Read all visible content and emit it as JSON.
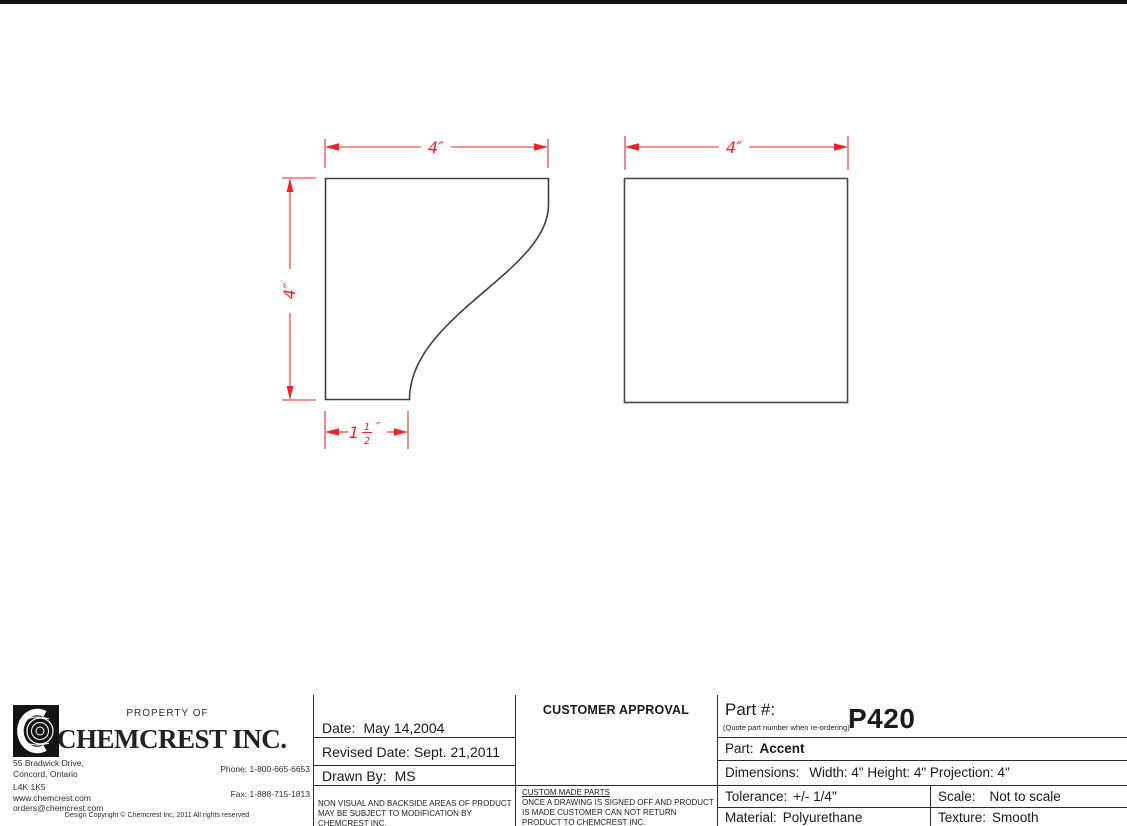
{
  "drawing": {
    "dim_color": "#ee2328",
    "outline_color": "#3f3f3f",
    "profile_view": {
      "width_label": "4″",
      "height_label": "4″",
      "bottom_width": {
        "whole": "1",
        "numerator": "1",
        "denominator": "2",
        "unit": "″"
      }
    },
    "face_view": {
      "width_label": "4″"
    }
  },
  "title_block": {
    "company": {
      "property_of": "PROPERTY OF",
      "name": "CHEMCREST INC.",
      "logo_icon": "chemcrest-c-medallion",
      "address_line1": "55 Bradwick Drive,",
      "address_line2": "Concord, Ontario",
      "address_line3": "L4K 1K5",
      "address_line4": "www.chemcrest.com",
      "address_line5": "orders@chemcrest.com",
      "phone": "Phone: 1-800-665-6653",
      "fax": "Fax: 1-888-715-1813",
      "copyright": "Design Copyright © Chemcrest Inc, 2011 All rights reserved"
    },
    "dates": {
      "date_label": "Date:",
      "date_value": "May 14,2004",
      "revised_label": "Revised Date:",
      "revised_value": "Sept. 21,2011",
      "drawn_label": "Drawn By:",
      "drawn_value": "MS",
      "note": "NON VISUAL AND BACKSIDE AREAS OF PRODUCT MAY BE SUBJECT TO MODIFICATION BY CHEMCREST INC."
    },
    "approval": {
      "header": "CUSTOMER APPROVAL",
      "note_title": "CUSTOM MADE PARTS",
      "note_body": "ONCE A DRAWING IS SIGNED OFF AND PRODUCT IS MADE CUSTOMER CAN NOT RETURN PRODUCT TO CHEMCREST INC."
    },
    "part": {
      "number_label": "Part #:",
      "number_hint": "(Quote part number when re-ordering)",
      "number_value": "P420",
      "part_label": "Part:",
      "part_value": "Accent",
      "dimensions_label": "Dimensions:",
      "dimensions_value": "Width: 4\" Height: 4\" Projection: 4\"",
      "tolerance_label": "Tolerance:",
      "tolerance_value": "+/- 1/4\"",
      "scale_label": "Scale:",
      "scale_value": "Not to scale",
      "material_label": "Material:",
      "material_value": "Polyurethane",
      "texture_label": "Texture:",
      "texture_value": "Smooth"
    }
  }
}
